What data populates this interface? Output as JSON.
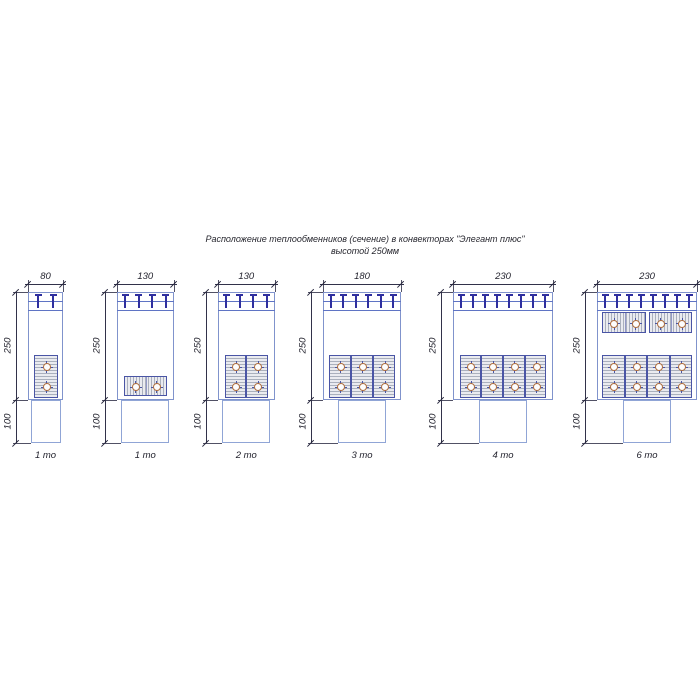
{
  "title": {
    "line1": "Расположение теплообменников (сечение) в конвекторах \"Элегант плюс\"",
    "line2": "высотой 250мм"
  },
  "dim_labels": {
    "height": "250",
    "base": "100"
  },
  "colors": {
    "body_stroke": "#8093cc",
    "pedestal_stroke": "#90a5d6",
    "grille_line": "#5f74c4",
    "tee_bracket": "#2f2f9f",
    "block_stroke": "#4a55a5",
    "block_hatch": "#aab0bd",
    "tube_ring": "#b06f3f",
    "dimension": "#32324a",
    "text": "#23232e"
  },
  "convectors": [
    {
      "width_label": "80",
      "width_units": 80,
      "label": "1 то",
      "x": 28,
      "body_w": 35,
      "tees": 2,
      "ped_w": 30,
      "top_row": null,
      "bottom_row": {
        "type": "vertical",
        "blocks": 1,
        "block_w": 24
      },
      "low_block": null
    },
    {
      "width_label": "130",
      "width_units": 130,
      "label": "1 то",
      "x": 117,
      "body_w": 56.5,
      "tees": 4,
      "ped_w": 48,
      "top_row": null,
      "bottom_row": null,
      "low_block": {
        "blocks": 1,
        "block_w": 43
      }
    },
    {
      "width_label": "130",
      "width_units": 130,
      "label": "2 то",
      "x": 218,
      "body_w": 56.5,
      "tees": 4,
      "ped_w": 48,
      "top_row": null,
      "bottom_row": {
        "type": "vertical",
        "blocks": 2,
        "block_w": 21.7
      },
      "low_block": null
    },
    {
      "width_label": "180",
      "width_units": 180,
      "label": "3 то",
      "x": 323,
      "body_w": 78,
      "tees": 6,
      "ped_w": 48,
      "top_row": null,
      "bottom_row": {
        "type": "vertical",
        "blocks": 3,
        "block_w": 22.3
      },
      "low_block": null
    },
    {
      "width_label": "230",
      "width_units": 230,
      "label": "4 то",
      "x": 453,
      "body_w": 100,
      "tees": 8,
      "ped_w": 48,
      "top_row": null,
      "bottom_row": {
        "type": "vertical",
        "blocks": 4,
        "block_w": 21.7
      },
      "low_block": null
    },
    {
      "width_label": "230",
      "width_units": 230,
      "label": "6 то",
      "x": 597,
      "body_w": 100,
      "tees": 8,
      "ped_w": 48,
      "top_row": {
        "blocks": 2,
        "block_w": 43.5
      },
      "bottom_row": {
        "type": "vertical",
        "blocks": 4,
        "block_w": 22.5
      },
      "low_block": null
    }
  ]
}
